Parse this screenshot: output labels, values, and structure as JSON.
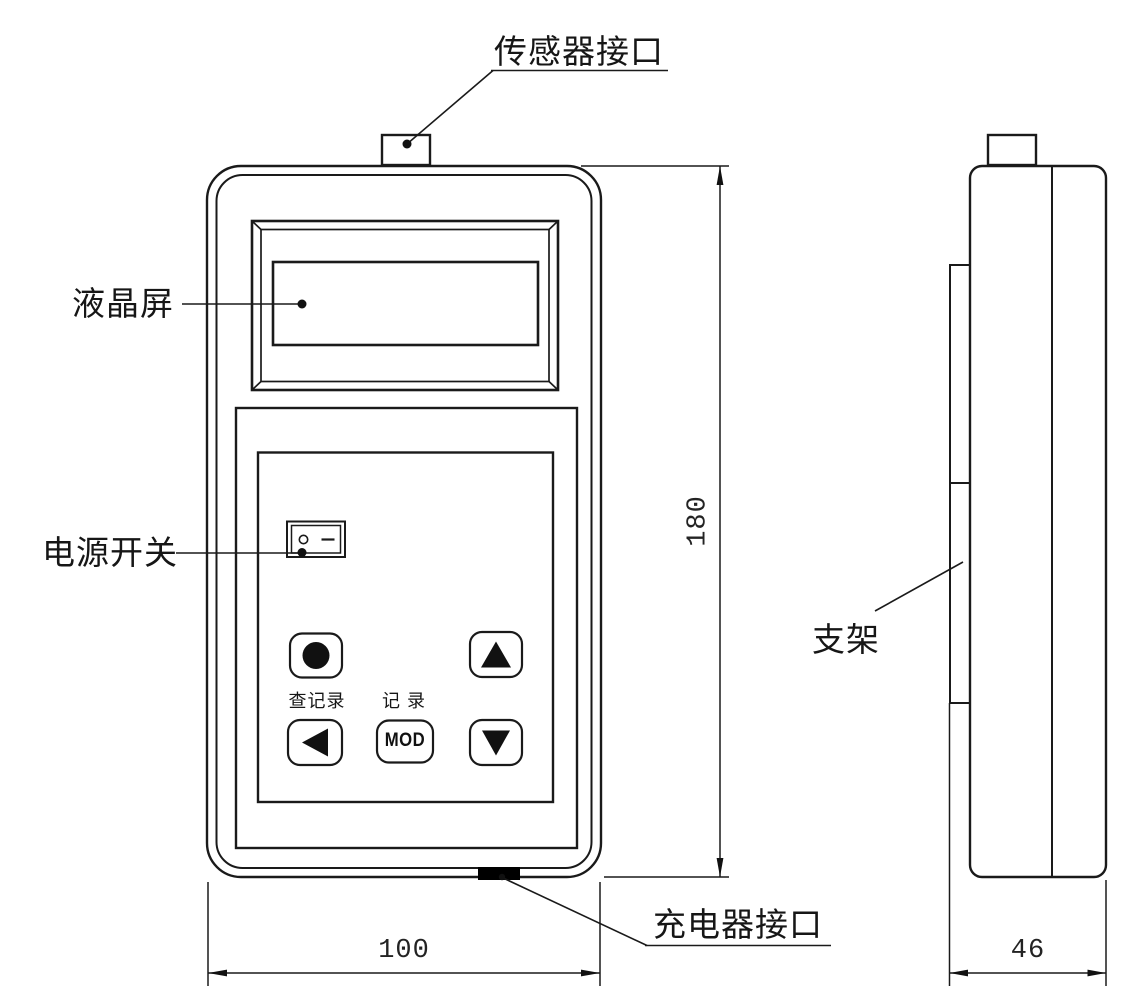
{
  "labels": {
    "sensor_port": "传感器接口",
    "lcd_screen": "液晶屏",
    "power_switch": "电源开关",
    "check_record": "查记录",
    "record": "记 录",
    "mod": "MOD",
    "charger_port": "充电器接口",
    "bracket": "支架"
  },
  "dimensions": {
    "front_width": "100",
    "front_height": "180",
    "side_width": "46"
  },
  "icons": {
    "record-dot-icon": "●",
    "up-arrow-icon": "▲",
    "left-arrow-icon": "◀",
    "down-arrow-icon": "▼",
    "switch-off-icon": "○",
    "switch-on-icon": "—"
  },
  "colors": {
    "line": "#1a1a1a",
    "background": "#ffffff",
    "port_fill": "#000000"
  }
}
